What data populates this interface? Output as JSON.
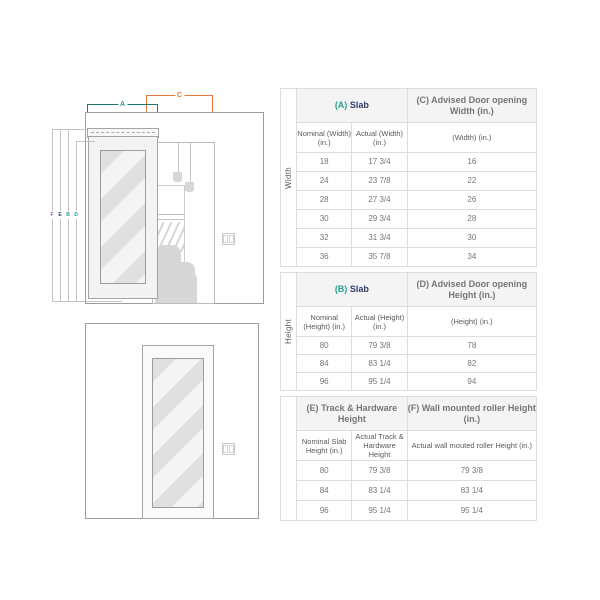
{
  "colors": {
    "teal": "#2aa18f",
    "orange": "#e0722e",
    "navy": "#323a68",
    "purple": "#a055a8",
    "table_border": "#dddddd",
    "header_bg": "#f4f4f4",
    "diagram_line": "#9d9d9d"
  },
  "diagram": {
    "top": {
      "a": "A",
      "c": "C"
    },
    "side": {
      "f": "F",
      "e": "E",
      "b": "B",
      "d": "D"
    }
  },
  "tables": [
    {
      "side_label": "Width",
      "header_left_prefix": "(A)",
      "header_left_text": "Slab",
      "header_right_prefix": "(C)",
      "header_right_text": "Advised Door opening Width (in.)",
      "subheaders": [
        "Nominal (Width) (in.)",
        "Actual (Width) (in.)",
        "(Width) (in.)"
      ],
      "rows": [
        [
          "18",
          "17 3/4",
          "16"
        ],
        [
          "24",
          "23 7/8",
          "22"
        ],
        [
          "28",
          "27 3/4",
          "26"
        ],
        [
          "30",
          "29 3/4",
          "28"
        ],
        [
          "32",
          "31 3/4",
          "30"
        ],
        [
          "36",
          "35 7/8",
          "34"
        ]
      ]
    },
    {
      "side_label": "Height",
      "header_left_prefix": "(B)",
      "header_left_text": "Slab",
      "header_right_prefix": "(D)",
      "header_right_text": "Advised Door opening Height (in.)",
      "subheaders": [
        "Nominal (Height) (in.)",
        "Actual (Height) (in.)",
        "(Height) (in.)"
      ],
      "rows": [
        [
          "80",
          "79 3/8",
          "78"
        ],
        [
          "84",
          "83 1/4",
          "82"
        ],
        [
          "96",
          "95 1/4",
          "94"
        ]
      ]
    },
    {
      "side_label": "",
      "header_left_prefix": "(E)",
      "header_left_text": "Track & Hardware Height",
      "header_right_prefix": "(F)",
      "header_right_text": "Wall mounted roller Height (in.)",
      "subheaders": [
        "Nominal Slab Height (in.)",
        "Actual Track & Hardware Height",
        "Actual wall mouted roller Height (in.)"
      ],
      "rows": [
        [
          "80",
          "79 3/8",
          "79 3/8"
        ],
        [
          "84",
          "83 1/4",
          "83 1/4"
        ],
        [
          "96",
          "95 1/4",
          "95 1/4"
        ]
      ]
    }
  ]
}
